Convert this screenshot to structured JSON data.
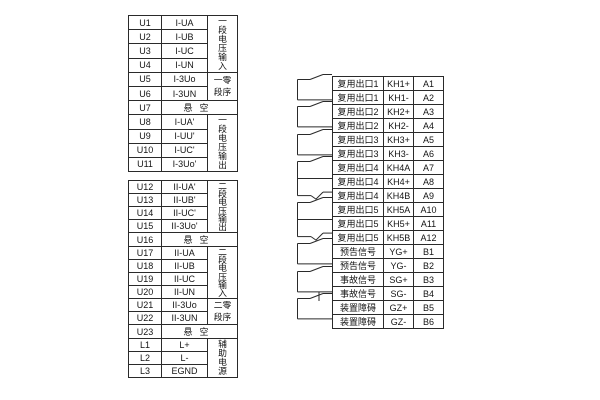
{
  "meta": {
    "title": "terminal-wiring-diagram"
  },
  "colors": {
    "background": "#ffffff",
    "line": "#2a2a2a",
    "text": "#141414"
  },
  "left_tables": [
    {
      "id": "voltage-terminals-section-1",
      "rows": [
        {
          "id": "U1",
          "label": "I-UA"
        },
        {
          "id": "U2",
          "label": "I-UB"
        },
        {
          "id": "U3",
          "label": "I-UC"
        },
        {
          "id": "U4",
          "label": "I-UN"
        },
        {
          "id": "U5",
          "label": "I-3Uo"
        },
        {
          "id": "U6",
          "label": "I-3UN"
        },
        {
          "id": "U7",
          "label": "悬空",
          "merged": true
        },
        {
          "id": "U8",
          "label": "I-UA'"
        },
        {
          "id": "U9",
          "label": "I-UU'"
        },
        {
          "id": "U10",
          "label": "I-UC'"
        },
        {
          "id": "U11",
          "label": "I-3Uo'"
        }
      ],
      "groups": [
        {
          "text": "一段电压输入",
          "start": 0,
          "span": 4,
          "wrap": 1
        },
        {
          "text": "一零段序",
          "start": 4,
          "span": 2,
          "wrap": 2
        },
        {
          "text": "一段电压输出",
          "start": 7,
          "span": 4,
          "wrap": 1
        }
      ]
    },
    {
      "id": "voltage-terminals-section-2",
      "rows": [
        {
          "id": "U12",
          "label": "II-UA'"
        },
        {
          "id": "U13",
          "label": "II-UB'"
        },
        {
          "id": "U14",
          "label": "II-UC'"
        },
        {
          "id": "U15",
          "label": "II-3Uo'"
        },
        {
          "id": "U16",
          "label": "悬空",
          "merged": true
        },
        {
          "id": "U17",
          "label": "II-UA"
        },
        {
          "id": "U18",
          "label": "II-UB"
        },
        {
          "id": "U19",
          "label": "II-UC"
        },
        {
          "id": "U20",
          "label": "II-UN"
        },
        {
          "id": "U21",
          "label": "II-3Uo"
        },
        {
          "id": "U22",
          "label": "II-3UN"
        },
        {
          "id": "U23",
          "label": "悬空",
          "merged": true
        },
        {
          "id": "L1",
          "label": "L+"
        },
        {
          "id": "L2",
          "label": "L-"
        },
        {
          "id": "L3",
          "label": "EGND"
        }
      ],
      "groups": [
        {
          "text": "二段电压输出",
          "start": 0,
          "span": 4,
          "wrap": 1
        },
        {
          "text": "二段电压输入",
          "start": 5,
          "span": 4,
          "wrap": 1
        },
        {
          "text": "二零段序",
          "start": 9,
          "span": 2,
          "wrap": 2
        },
        {
          "text": "辅助电源",
          "start": 12,
          "span": 3,
          "wrap": 1
        }
      ]
    }
  ],
  "right_table": {
    "id": "output-contact-terminals",
    "rows": [
      {
        "name": "复用出口1",
        "terminal": "KH1+",
        "pin": "A1"
      },
      {
        "name": "复用出口1",
        "terminal": "KH1-",
        "pin": "A2"
      },
      {
        "name": "复用出口2",
        "terminal": "KH2+",
        "pin": "A3"
      },
      {
        "name": "复用出口2",
        "terminal": "KH2-",
        "pin": "A4"
      },
      {
        "name": "复用出口3",
        "terminal": "KH3+",
        "pin": "A5"
      },
      {
        "name": "复用出口3",
        "terminal": "KH3-",
        "pin": "A6"
      },
      {
        "name": "复用出口4",
        "terminal": "KH4A",
        "pin": "A7"
      },
      {
        "name": "复用出口4",
        "terminal": "KH4+",
        "pin": "A8"
      },
      {
        "name": "复用出口4",
        "terminal": "KH4B",
        "pin": "A9"
      },
      {
        "name": "复用出口5",
        "terminal": "KH5A",
        "pin": "A10"
      },
      {
        "name": "复用出口5",
        "terminal": "KH5+",
        "pin": "A11"
      },
      {
        "name": "复用出口5",
        "terminal": "KH5B",
        "pin": "A12"
      },
      {
        "name": "预告信号",
        "terminal": "YG+",
        "pin": "B1"
      },
      {
        "name": "预告信号",
        "terminal": "YG-",
        "pin": "B2"
      },
      {
        "name": "事故信号",
        "terminal": "SG+",
        "pin": "B3"
      },
      {
        "name": "事故信号",
        "terminal": "SG-",
        "pin": "B4"
      },
      {
        "name": "装置障碍",
        "terminal": "GZ+",
        "pin": "B5"
      },
      {
        "name": "装置障碍",
        "terminal": "GZ-",
        "pin": "B6"
      }
    ],
    "groups": [
      {
        "start": 0,
        "span": 2,
        "contact": "no"
      },
      {
        "start": 2,
        "span": 2,
        "contact": "no"
      },
      {
        "start": 4,
        "span": 2,
        "contact": "no"
      },
      {
        "start": 6,
        "span": 3,
        "contact": "changeover"
      },
      {
        "start": 9,
        "span": 3,
        "contact": "changeover"
      },
      {
        "start": 12,
        "span": 2,
        "contact": "no"
      },
      {
        "start": 14,
        "span": 2,
        "contact": "no"
      },
      {
        "start": 16,
        "span": 2,
        "contact": "nc"
      }
    ]
  }
}
